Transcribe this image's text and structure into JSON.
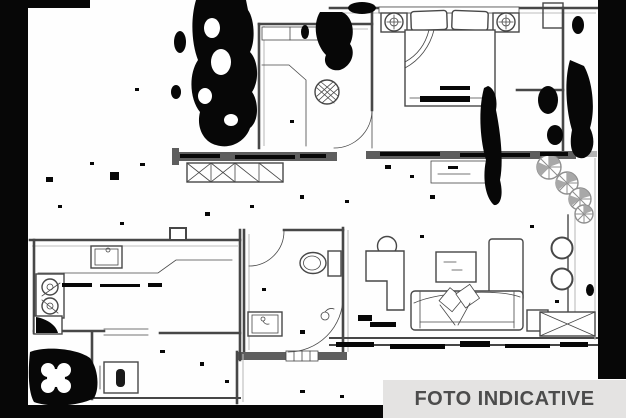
{
  "banner": {
    "label": "FOTO INDICATIVE"
  },
  "colors": {
    "banner_background": "#e4e3e2",
    "banner_text": "#4c4c4c",
    "line_ink": "#474747",
    "wall_fill": "#5e5e5e",
    "soft_gray": "#bdbdbd",
    "noise_black": "#070707",
    "plant_gray": "#8f8f8f",
    "canvas": "#fefefe"
  },
  "furniture": [
    "double-bed",
    "nightstand-lamp-left",
    "nightstand-lamp-right",
    "entry-round-table",
    "toilet",
    "bathroom-sink",
    "shower",
    "kitchen-sink",
    "stove",
    "corner-cabinet",
    "washing-machine",
    "sofa",
    "coffee-table",
    "armchair",
    "chaise-cabinet",
    "side-table",
    "tv-unit",
    "balcony-plants",
    "balcony-chairs",
    "window-crossed-box",
    "wardrobe-crossed-boxes"
  ]
}
